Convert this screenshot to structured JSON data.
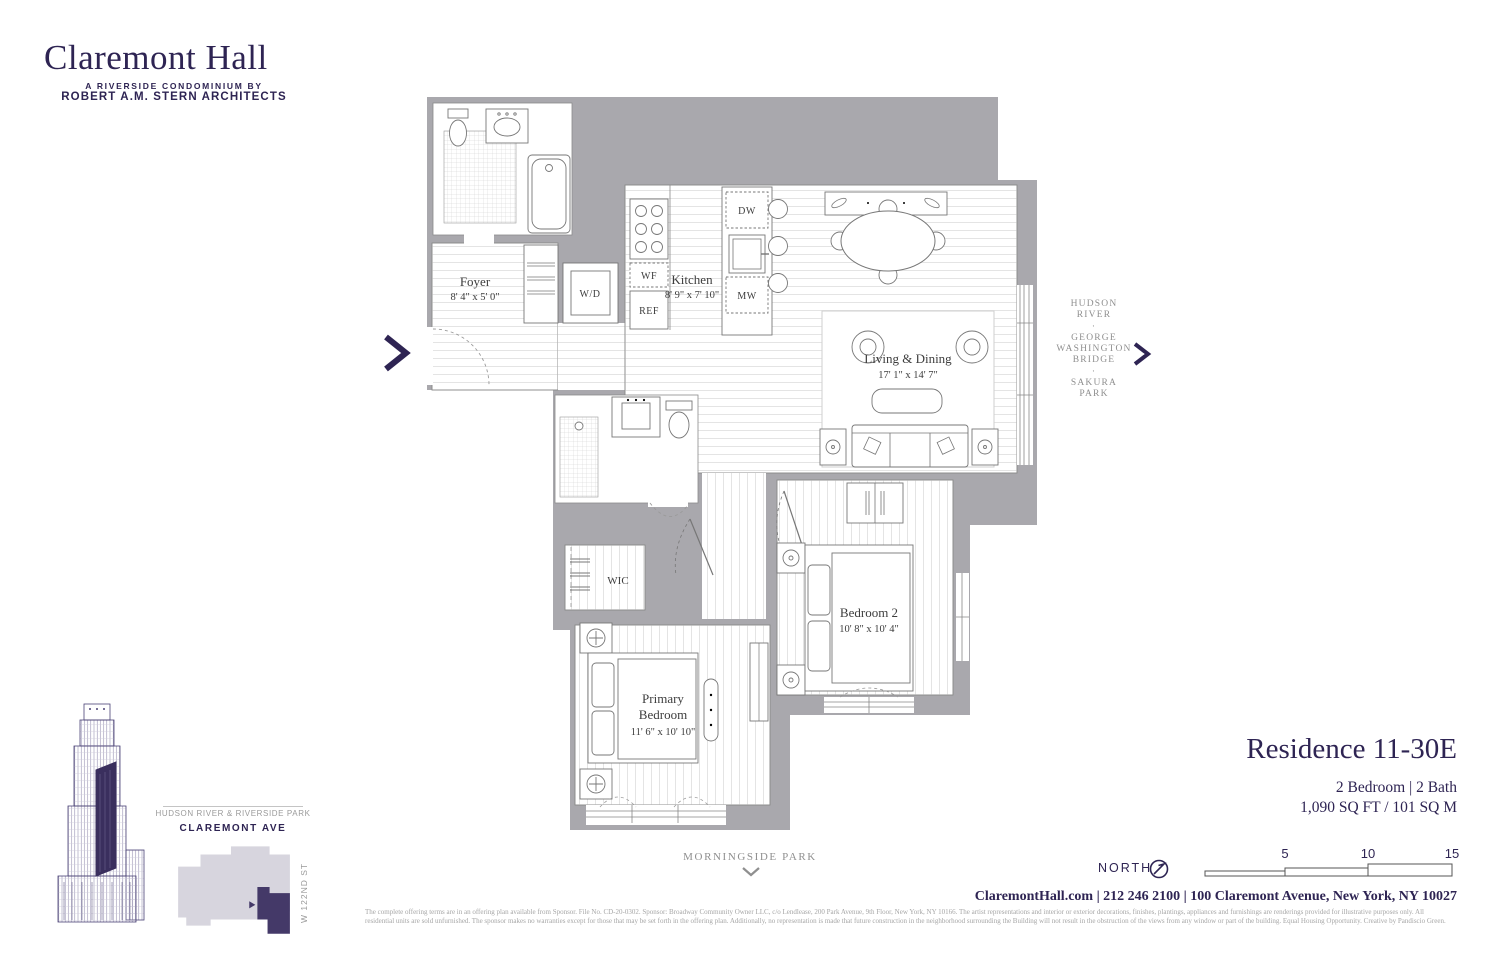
{
  "brand": {
    "name": "Claremont Hall",
    "tagline1": "A RIVERSIDE CONDOMINIUM BY",
    "tagline2": "ROBERT A.M. STERN ARCHITECTS"
  },
  "plan": {
    "rooms": {
      "foyer": {
        "name": "Foyer",
        "dims": "8' 4\" x 5' 0\""
      },
      "kitchen": {
        "name": "Kitchen",
        "dims": "8' 9\" x 7' 10\""
      },
      "living": {
        "name": "Living & Dining",
        "dims": "17' 1\" x 14' 7\""
      },
      "bedroom2": {
        "name": "Bedroom 2",
        "dims": "10' 8\" x 10' 4\""
      },
      "primary": {
        "l1": "Primary",
        "l2": "Bedroom",
        "dims": "11' 6\" x 10' 10\""
      },
      "wic": {
        "name": "WIC"
      }
    },
    "appliances": {
      "wd": "W/D",
      "wf": "WF",
      "ref": "REF",
      "dw": "DW",
      "mw": "MW"
    }
  },
  "annotations": {
    "view_right": [
      "HUDSON",
      "RIVER",
      "·",
      "GEORGE",
      "WASHINGTON",
      "BRIDGE",
      "·",
      "SAKURA",
      "PARK"
    ],
    "south": "MORNINGSIDE PARK"
  },
  "key_map": {
    "park": "HUDSON RIVER & RIVERSIDE PARK",
    "avenue": "CLAREMONT AVE",
    "street": "W 122ND ST"
  },
  "residence": {
    "title": "Residence 11-30E",
    "config": "2 Bedroom | 2 Bath",
    "area": "1,090 SQ FT / 101 SQ M"
  },
  "compass": {
    "label": "NORTH"
  },
  "scale_bar": {
    "t1": "5",
    "t2": "10",
    "t3": "15"
  },
  "contact": "ClaremontHall.com | 212 246 2100 | 100 Claremont Avenue, New York, NY 10027",
  "disclaimer": {
    "line1": "The complete offering terms are in an offering plan available from Sponsor. File No. CD-20-0302. Sponsor: Broadway Community Owner LLC, c/o Lendlease, 200 Park Avenue, 9th Floor, New York, NY 10166. The artist representations and interior or exterior decorations, finishes, plantings, appliances and furnishings are renderings provided for illustrative purposes only. All",
    "line2": "residential units are sold unfurnished. The sponsor makes no warranties except for those that may be set forth in the offering plan. Additionally, no representation is made that future construction in the neighborhood surrounding the Building will not result in the obstruction of the views from any window or part of the building. Equal Housing Opportunity. Creative by Pandiscio Green."
  },
  "colors": {
    "brand": "#2e2453",
    "wall": "#a9a8ad",
    "unit_highlight": "#443968",
    "footprint": "#d7d5de",
    "muted_text": "#8f8f8f"
  }
}
